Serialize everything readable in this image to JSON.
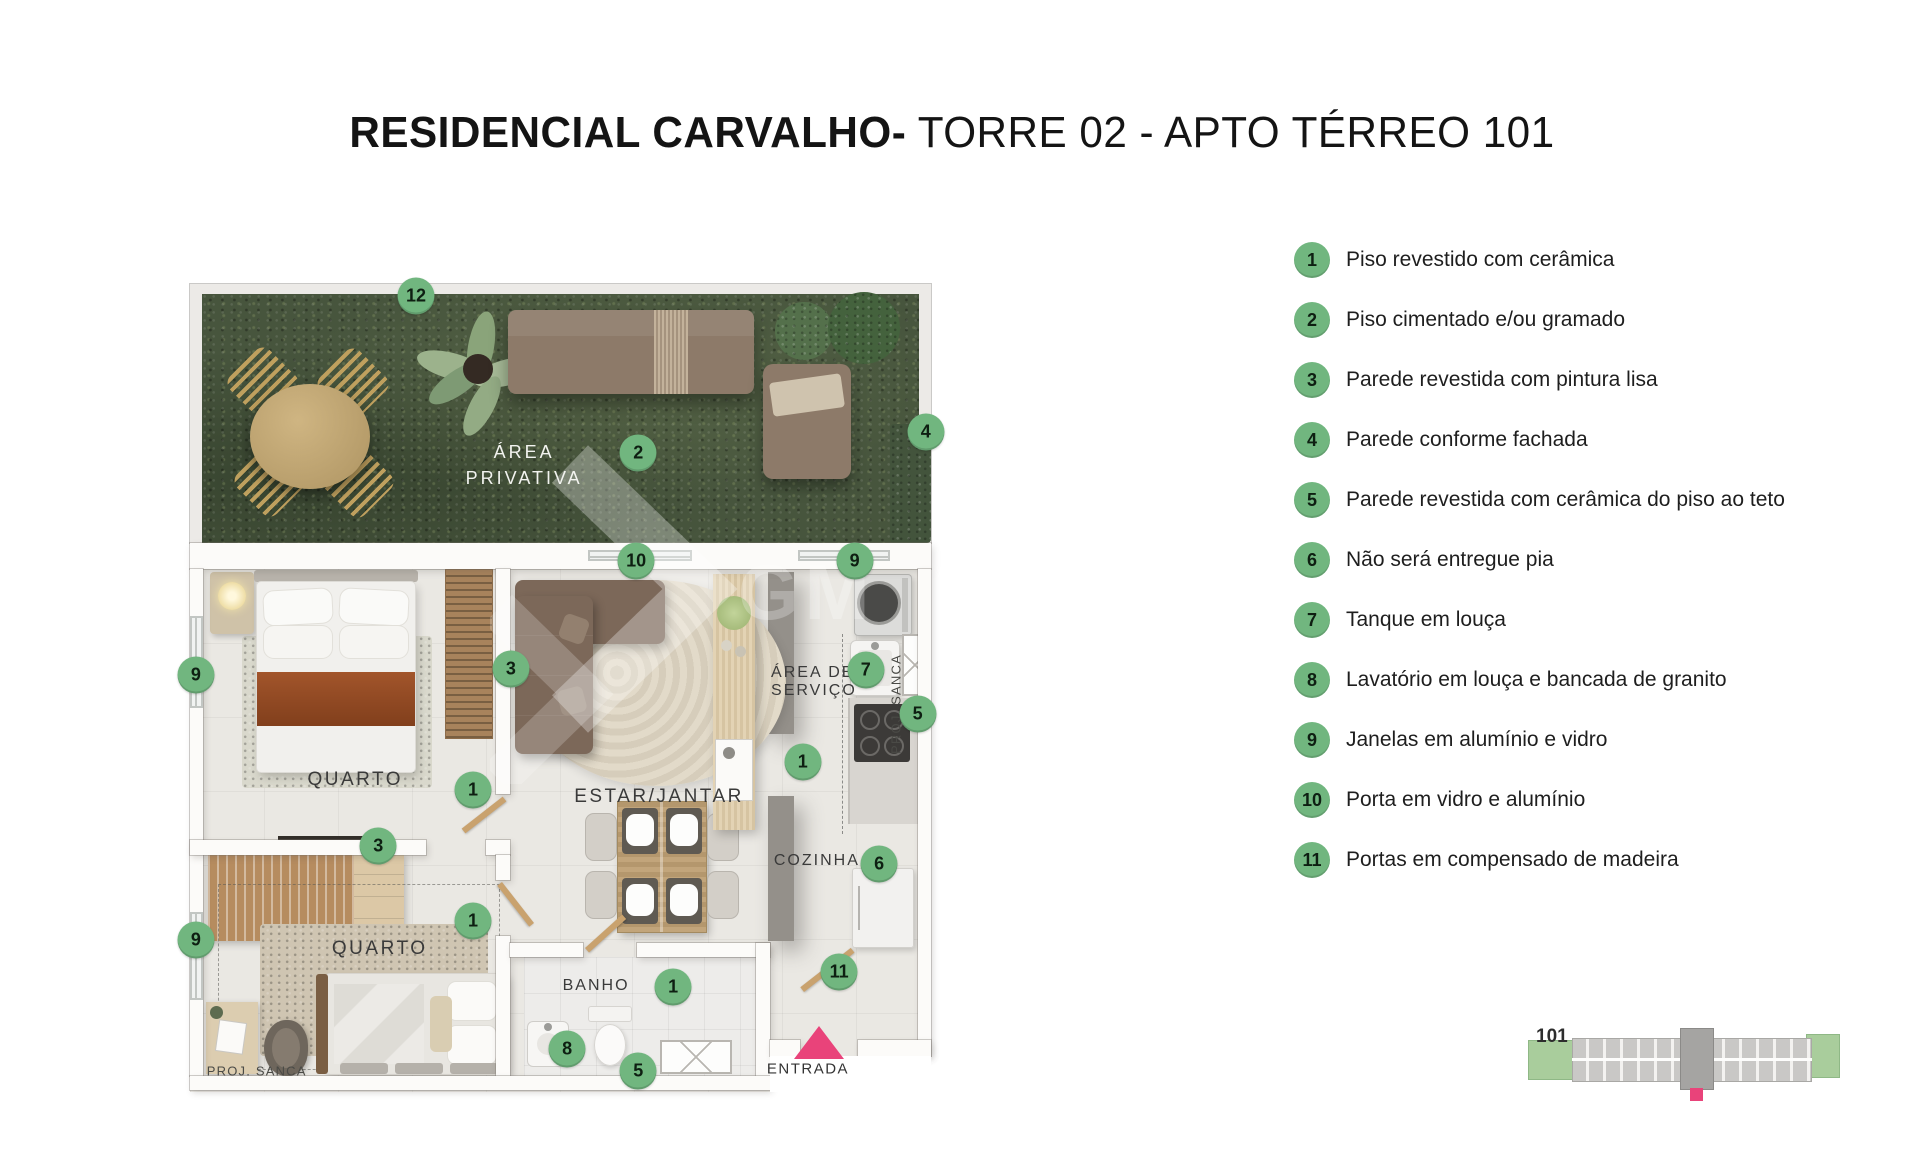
{
  "title": {
    "bold": "RESIDENCIAL CARVALHO-",
    "regular": " TORRE 02 - APTO TÉRREO 101"
  },
  "legend": {
    "items": [
      {
        "num": "1",
        "label": "Piso revestido com cerâmica"
      },
      {
        "num": "2",
        "label": "Piso cimentado e/ou gramado"
      },
      {
        "num": "3",
        "label": "Parede revestida com pintura lisa"
      },
      {
        "num": "4",
        "label": "Parede conforme fachada"
      },
      {
        "num": "5",
        "label": "Parede revestida com cerâmica do piso ao teto"
      },
      {
        "num": "6",
        "label": "Não será entregue pia"
      },
      {
        "num": "7",
        "label": "Tanque em louça"
      },
      {
        "num": "8",
        "label": "Lavatório em louça e bancada de granito"
      },
      {
        "num": "9",
        "label": "Janelas em alumínio e vidro"
      },
      {
        "num": "10",
        "label": "Porta em vidro e alumínio"
      },
      {
        "num": "11",
        "label": "Portas em compensado de madeira"
      }
    ]
  },
  "plan": {
    "rooms": {
      "area_privativa_1": "ÁREA",
      "area_privativa_2": "PRIVATIVA",
      "quarto": "QUARTO",
      "estar_jantar": "ESTAR/JANTAR",
      "area_servico_1": "ÁREA DE",
      "area_servico_2": "SERVIÇO",
      "cozinha": "COZINHA",
      "banho": "BANHO",
      "proj_sanca": "PROJ. SANCA",
      "entrada": "ENTRADA"
    },
    "watermark_text": "GM",
    "markers": [
      {
        "n": "12",
        "x": 30.5,
        "y": 1.5
      },
      {
        "n": "2",
        "x": 60.5,
        "y": 20.9
      },
      {
        "n": "4",
        "x": 99.3,
        "y": 18.3
      },
      {
        "n": "10",
        "x": 60.2,
        "y": 34.3
      },
      {
        "n": "9",
        "x": 89.7,
        "y": 34.3
      },
      {
        "n": "9",
        "x": 0.8,
        "y": 48.4
      },
      {
        "n": "3",
        "x": 43.3,
        "y": 47.6
      },
      {
        "n": "7",
        "x": 91.2,
        "y": 47.8
      },
      {
        "n": "5",
        "x": 98.2,
        "y": 53.2
      },
      {
        "n": "1",
        "x": 38.2,
        "y": 62.6
      },
      {
        "n": "1",
        "x": 82.7,
        "y": 59.2
      },
      {
        "n": "3",
        "x": 25.4,
        "y": 69.6
      },
      {
        "n": "6",
        "x": 93.0,
        "y": 71.8
      },
      {
        "n": "1",
        "x": 38.2,
        "y": 78.8
      },
      {
        "n": "9",
        "x": 0.8,
        "y": 81.2
      },
      {
        "n": "11",
        "x": 87.6,
        "y": 85.1
      },
      {
        "n": "1",
        "x": 65.2,
        "y": 87.0
      },
      {
        "n": "8",
        "x": 50.9,
        "y": 94.7
      },
      {
        "n": "5",
        "x": 60.5,
        "y": 97.4
      }
    ]
  },
  "minimap": {
    "unit_label": "101"
  },
  "colors": {
    "accent_green": "#71b67f",
    "entry_pink": "#e9437a",
    "grass_green": "#47553d"
  }
}
